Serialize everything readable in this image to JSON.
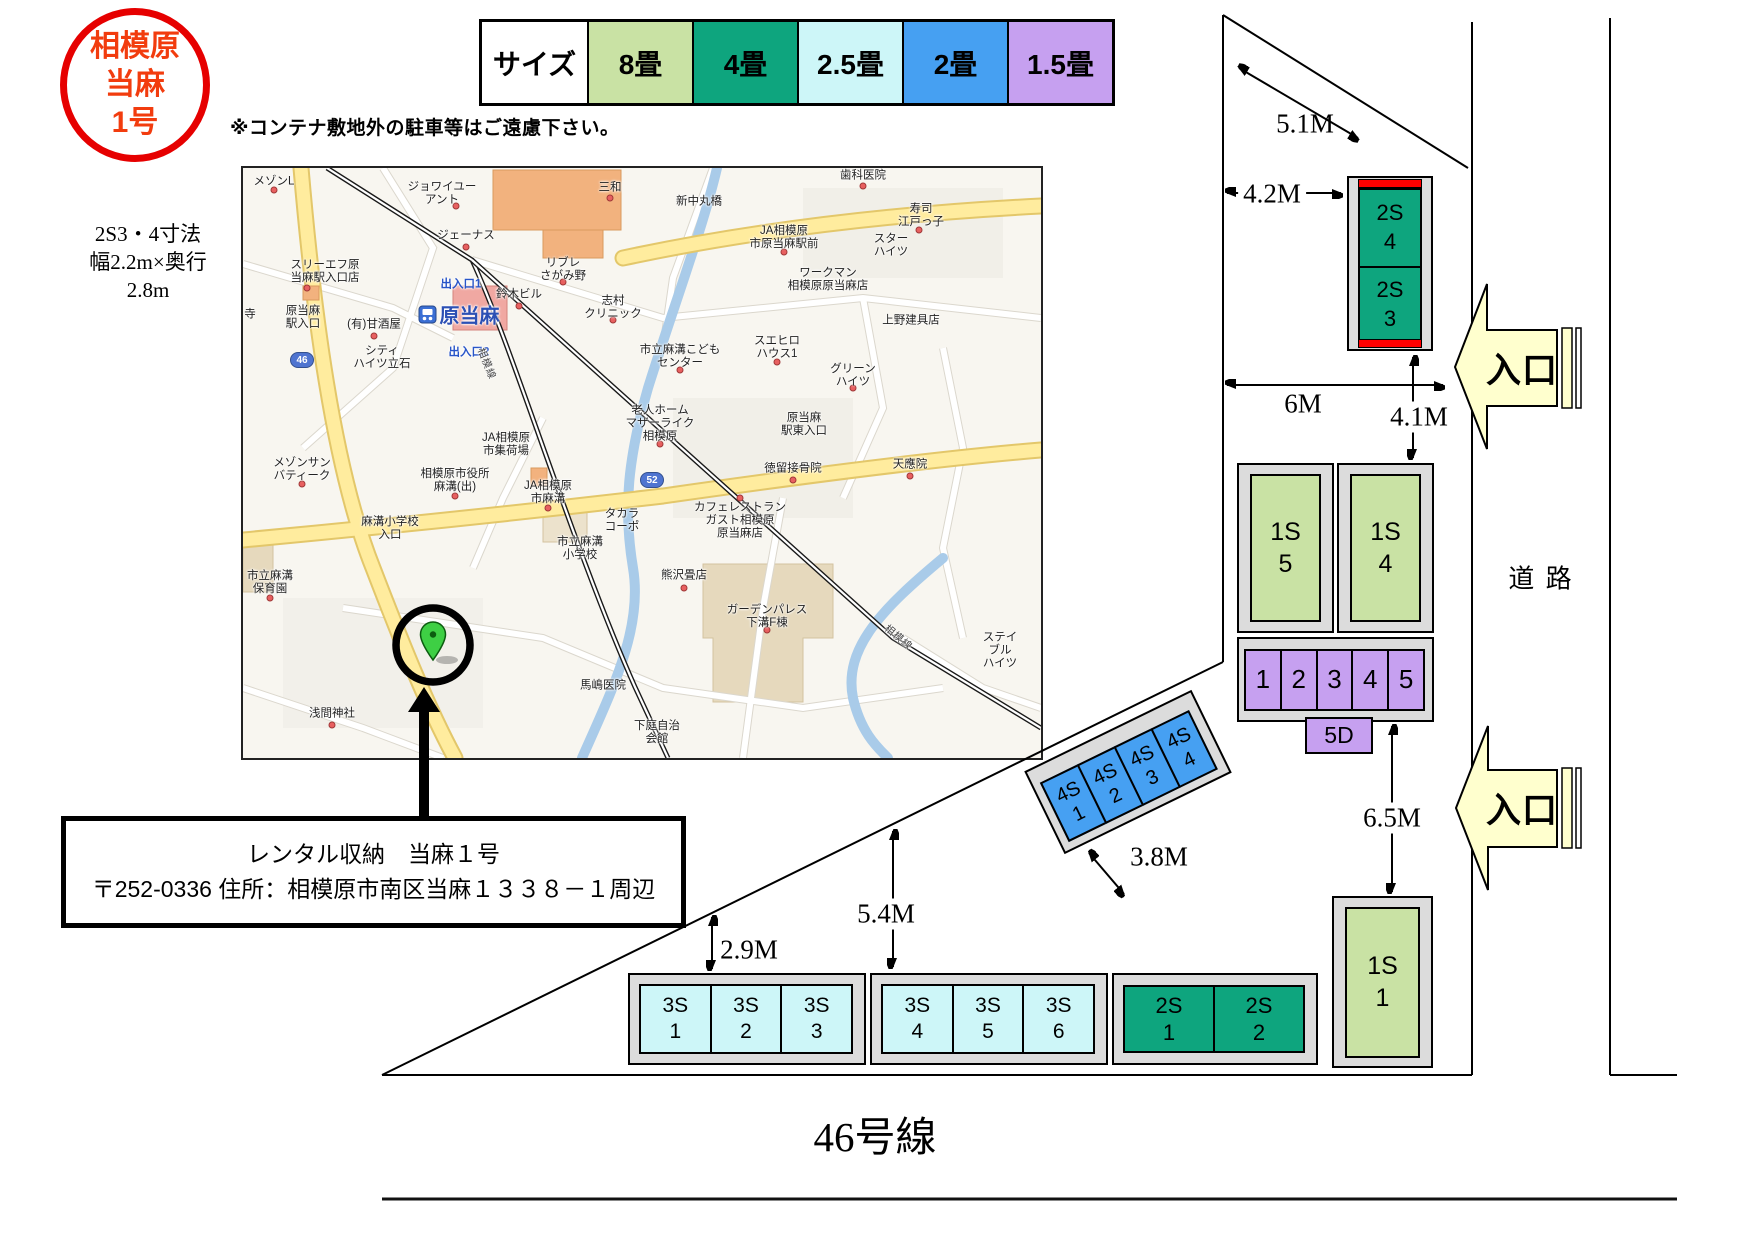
{
  "palette": {
    "jo8": "#c9e2a4",
    "jo4": "#0ea57e",
    "jo25": "#cdf6f8",
    "jo2": "#46a0f2",
    "jo15": "#c6a0f0",
    "red_strip": "#ff0000",
    "frame_gray": "#dcdcdc",
    "entrance_fill": "#ffffce",
    "badge_red": "#e60000"
  },
  "badge": {
    "line1": "相模原",
    "line2": "当麻",
    "line3": "1号"
  },
  "note": "※コンテナ敷地外の駐車等はご遠慮下さい。",
  "size_note": {
    "line1": "2S3・4寸法",
    "line2": "幅2.2m×奥行",
    "line3": "2.8m"
  },
  "legend": {
    "header": "サイズ",
    "items": [
      {
        "label": "8畳",
        "key": "jo8"
      },
      {
        "label": "4畳",
        "key": "jo4"
      },
      {
        "label": "2.5畳",
        "key": "jo25"
      },
      {
        "label": "2畳",
        "key": "jo2"
      },
      {
        "label": "1.5畳",
        "key": "jo15"
      }
    ]
  },
  "address": {
    "line1": "レンタル収納　当麻１号",
    "line2": "〒252-0336 住所：相模原市南区当麻１３３８－１周辺"
  },
  "measurements": {
    "m51": "5.1M",
    "m42": "4.2M",
    "m6": "6M",
    "m41": "4.1M",
    "m65": "6.5M",
    "m38": "3.8M",
    "m54": "5.4M",
    "m29": "2.9M"
  },
  "entrance": "入口",
  "road": "道 路",
  "route46": "46号線",
  "blocks": {
    "top2s": {
      "cells": [
        {
          "l1": "2S",
          "l2": "4"
        },
        {
          "l1": "2S",
          "l2": "3"
        }
      ]
    },
    "row1s": {
      "cells": [
        {
          "l1": "1S",
          "l2": "5"
        },
        {
          "l1": "1S",
          "l2": "4"
        }
      ]
    },
    "parking": {
      "cells": [
        {
          "n": "1"
        },
        {
          "n": "2"
        },
        {
          "n": "3"
        },
        {
          "n": "4"
        },
        {
          "n": "5"
        }
      ],
      "door": "5D"
    },
    "diag4s": {
      "cells": [
        {
          "l1": "4S",
          "l2": "1"
        },
        {
          "l1": "4S",
          "l2": "2"
        },
        {
          "l1": "4S",
          "l2": "3"
        },
        {
          "l1": "4S",
          "l2": "4"
        }
      ]
    },
    "row3a": {
      "cells": [
        {
          "l1": "3S",
          "l2": "1"
        },
        {
          "l1": "3S",
          "l2": "2"
        },
        {
          "l1": "3S",
          "l2": "3"
        }
      ]
    },
    "row3b": {
      "cells": [
        {
          "l1": "3S",
          "l2": "4"
        },
        {
          "l1": "3S",
          "l2": "5"
        },
        {
          "l1": "3S",
          "l2": "6"
        }
      ]
    },
    "row2s": {
      "cells": [
        {
          "l1": "2S",
          "l2": "1"
        },
        {
          "l1": "2S",
          "l2": "2"
        }
      ]
    },
    "solo1s": {
      "l1": "1S",
      "l2": "1"
    }
  },
  "map": {
    "station": "原当麻",
    "badge46": "46",
    "badge52": "52",
    "labels": [
      {
        "t": "メゾンL",
        "x": 31,
        "y": 14
      },
      {
        "t": "ジョワイユー\nアント",
        "x": 199,
        "y": 26
      },
      {
        "t": "ジェーナス",
        "x": 223,
        "y": 68
      },
      {
        "t": "三和",
        "x": 367,
        "y": 20
      },
      {
        "t": "新中丸橋",
        "x": 456,
        "y": 34
      },
      {
        "t": "歯科医院",
        "x": 620,
        "y": 8
      },
      {
        "t": "寿司\n江戸っ子",
        "x": 678,
        "y": 48
      },
      {
        "t": "スター\nハイツ",
        "x": 648,
        "y": 78
      },
      {
        "t": "JA相模原\n市原当麻駅前",
        "x": 541,
        "y": 70
      },
      {
        "t": "リブレ\nさがみ野",
        "x": 320,
        "y": 102
      },
      {
        "t": "スリーエフ原\n当麻駅入口店",
        "x": 82,
        "y": 104
      },
      {
        "t": "出入口1",
        "x": 218,
        "y": 117,
        "cls": "blue"
      },
      {
        "t": "鈴木ビル",
        "x": 276,
        "y": 127
      },
      {
        "t": "ワークマン\n相模原原当麻店",
        "x": 585,
        "y": 112
      },
      {
        "t": "志村\nクリニック",
        "x": 370,
        "y": 140
      },
      {
        "t": "寺",
        "x": 7,
        "y": 147
      },
      {
        "t": "原当麻\n駅入口",
        "x": 60,
        "y": 150
      },
      {
        "t": "(有)甘酒屋",
        "x": 131,
        "y": 157
      },
      {
        "t": "上野建具店",
        "x": 668,
        "y": 153
      },
      {
        "t": "スエヒロ\nハウス1",
        "x": 534,
        "y": 180
      },
      {
        "t": "出入口2",
        "x": 226,
        "y": 185,
        "cls": "blue"
      },
      {
        "t": "シティ\nハイツ立石",
        "x": 139,
        "y": 190
      },
      {
        "t": "グリーン\nハイツ",
        "x": 610,
        "y": 208
      },
      {
        "t": "市立麻溝こども\nセンター",
        "x": 437,
        "y": 189
      },
      {
        "t": "老人ホーム\nマザーライク\n相模原",
        "x": 417,
        "y": 256
      },
      {
        "t": "原当麻\n駅東入口",
        "x": 561,
        "y": 257
      },
      {
        "t": "JA相模原\n市集荷場",
        "x": 263,
        "y": 277
      },
      {
        "t": "天應院",
        "x": 667,
        "y": 297
      },
      {
        "t": "徳留接骨院",
        "x": 550,
        "y": 301
      },
      {
        "t": "相模原市役所\n麻溝(出)",
        "x": 212,
        "y": 313
      },
      {
        "t": "JA相模原\n市麻溝",
        "x": 305,
        "y": 325
      },
      {
        "t": "メゾンサン\nバティーク",
        "x": 59,
        "y": 302
      },
      {
        "t": "カフェレストラン\nガスト相模原\n原当麻店",
        "x": 497,
        "y": 353
      },
      {
        "t": "タカラ\nコーポ",
        "x": 379,
        "y": 353
      },
      {
        "t": "麻溝小学校\n入口",
        "x": 147,
        "y": 361
      },
      {
        "t": "市立麻溝\n小学校",
        "x": 337,
        "y": 381
      },
      {
        "t": "熊沢畳店",
        "x": 441,
        "y": 408
      },
      {
        "t": "市立麻溝\n保育園",
        "x": 27,
        "y": 415
      },
      {
        "t": "ガーデンパレス\n下溝F棟",
        "x": 524,
        "y": 449
      },
      {
        "t": "ステイブル\nハイツ",
        "x": 757,
        "y": 483
      },
      {
        "t": "浅間神社",
        "x": 89,
        "y": 546
      },
      {
        "t": "馬嶋医院",
        "x": 360,
        "y": 518
      },
      {
        "t": "下庭自治\n会館",
        "x": 414,
        "y": 565
      },
      {
        "t": "相模線",
        "x": 243,
        "y": 196,
        "cls": "rail",
        "rot": 68
      },
      {
        "t": "相模線",
        "x": 655,
        "y": 470,
        "cls": "rail",
        "rot": 40
      }
    ],
    "dots": [
      {
        "x": 31,
        "y": 22
      },
      {
        "x": 213,
        "y": 38
      },
      {
        "x": 223,
        "y": 79
      },
      {
        "x": 367,
        "y": 30
      },
      {
        "x": 620,
        "y": 18
      },
      {
        "x": 676,
        "y": 62
      },
      {
        "x": 541,
        "y": 84
      },
      {
        "x": 320,
        "y": 114
      },
      {
        "x": 64,
        "y": 120
      },
      {
        "x": 276,
        "y": 138
      },
      {
        "x": 370,
        "y": 152
      },
      {
        "x": 131,
        "y": 168
      },
      {
        "x": 534,
        "y": 194
      },
      {
        "x": 610,
        "y": 220
      },
      {
        "x": 437,
        "y": 202
      },
      {
        "x": 417,
        "y": 276
      },
      {
        "x": 550,
        "y": 312
      },
      {
        "x": 212,
        "y": 328
      },
      {
        "x": 305,
        "y": 340
      },
      {
        "x": 59,
        "y": 316
      },
      {
        "x": 497,
        "y": 330
      },
      {
        "x": 441,
        "y": 420
      },
      {
        "x": 27,
        "y": 430
      },
      {
        "x": 524,
        "y": 462
      },
      {
        "x": 89,
        "y": 557
      },
      {
        "x": 667,
        "y": 308
      }
    ]
  }
}
